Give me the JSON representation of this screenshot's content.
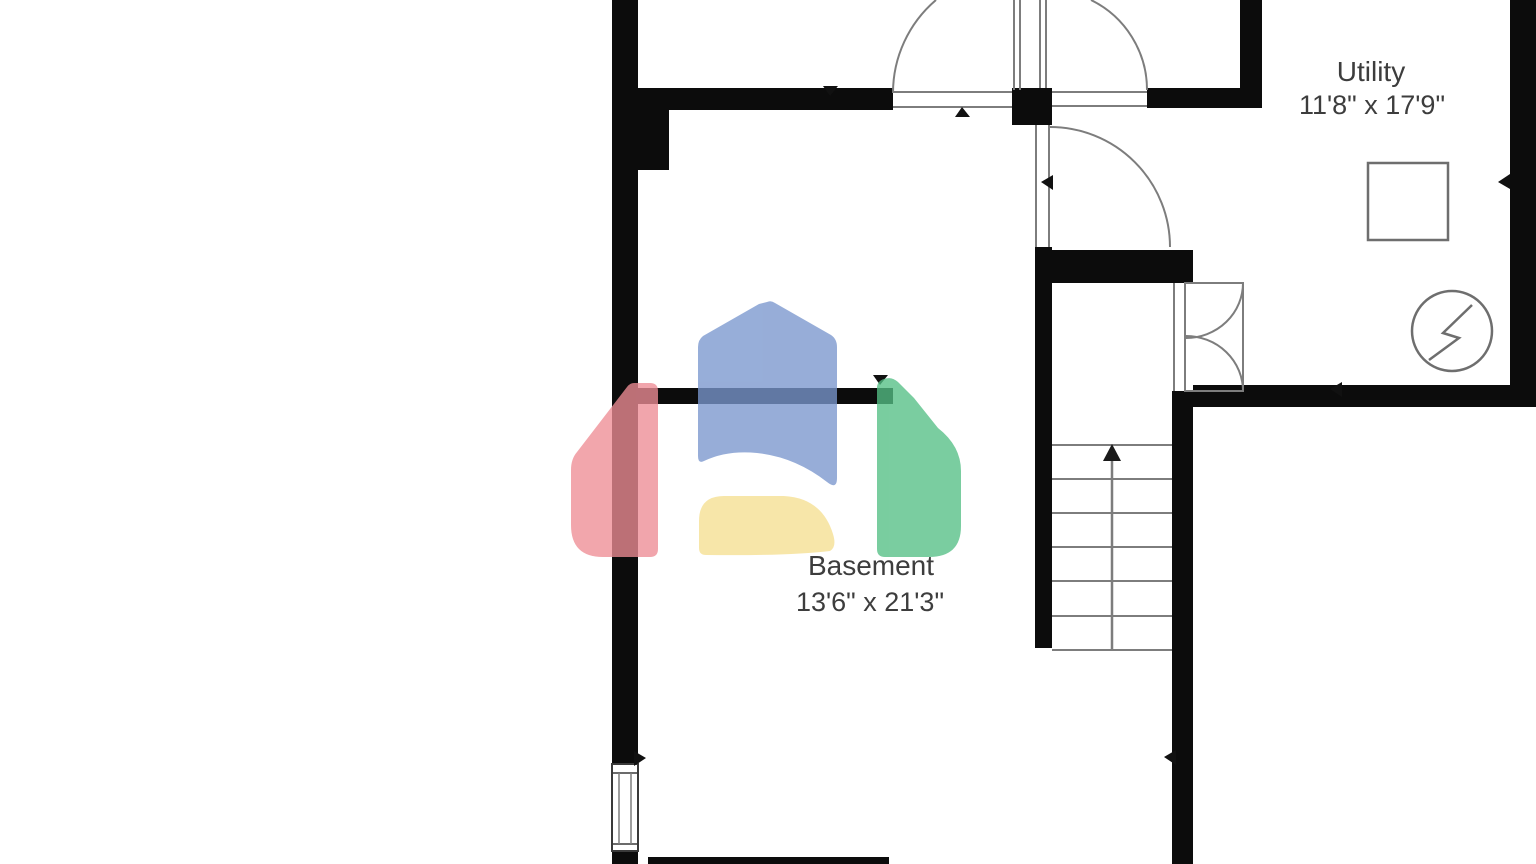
{
  "plan": {
    "title": "Basement floor plan",
    "rooms": [
      {
        "name": "Utility",
        "dimensions": "11'8\" x 17'9\""
      },
      {
        "name": "Basement",
        "dimensions": "13'6\" x 21'3\""
      }
    ],
    "colors": {
      "wall": "#0c0c0c",
      "line": "#7d7d7d",
      "fixture_line": "#6e6e6e",
      "label": "#3d3d3d"
    }
  },
  "watermark": {
    "icon": "house-logo",
    "colors": {
      "blue": "#7a97ce",
      "red": "#ee8d95",
      "green": "#54bf85",
      "yellow": "#f6e092"
    }
  }
}
